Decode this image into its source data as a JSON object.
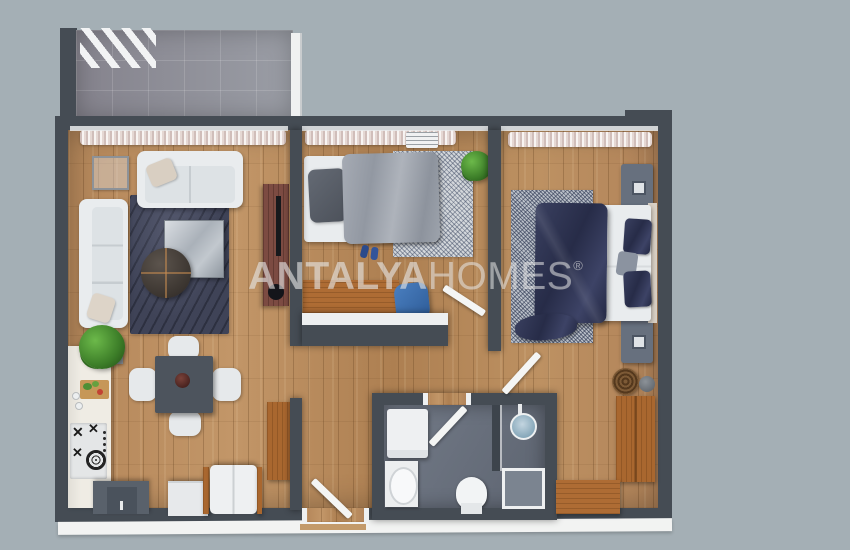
{
  "watermark": {
    "brand": "ANTALYA",
    "brand_suffix": "HOMES",
    "trademark": "®"
  },
  "palette": {
    "background": "#a4afb5",
    "wall": "#454c54",
    "wood_floor": "#b88c5d",
    "bathroom_floor": "#6a7280",
    "balcony_tile": "#8e8e97",
    "white_furniture": "#e9ecee",
    "wood_furniture": "#ae6c34",
    "navy_bedding": "#2b3150",
    "grey_bedding": "#9ba1ab",
    "watermark_color": "rgba(255,255,255,0.5)"
  },
  "floor_plan": {
    "style": "3d-top-down-apartment-render",
    "rooms": [
      {
        "name": "balcony",
        "floor": "grey-tile",
        "items": [
          "railing",
          "slats"
        ]
      },
      {
        "name": "living-room-kitchen",
        "floor": "wood",
        "items": [
          "two-seat-sofa",
          "three-seat-sofa",
          "area-rug",
          "coffee-table",
          "round-table",
          "side-table",
          "tv-unit",
          "potted-plant",
          "dining-table",
          "dining-chairs",
          "kitchen-counter",
          "hob",
          "cutting-board",
          "kitchen-cabinets",
          "fridge"
        ]
      },
      {
        "name": "bedroom-1",
        "floor": "wood",
        "items": [
          "single-bed",
          "area-rug",
          "desk",
          "desk-chair",
          "potted-plant",
          "slippers",
          "ac-vent",
          "curtains"
        ]
      },
      {
        "name": "bedroom-2",
        "floor": "wood",
        "items": [
          "double-bed",
          "area-rug",
          "nightstand",
          "nightstand",
          "wardrobe",
          "bench",
          "baskets",
          "curtains"
        ]
      },
      {
        "name": "bathroom",
        "floor": "grey-tile",
        "items": [
          "washing-machine",
          "washbasin",
          "toilet",
          "shower",
          "glass-partition"
        ]
      },
      {
        "name": "entrance-hall",
        "floor": "wood",
        "items": [
          "shoe-cabinet",
          "front-door"
        ]
      }
    ]
  }
}
